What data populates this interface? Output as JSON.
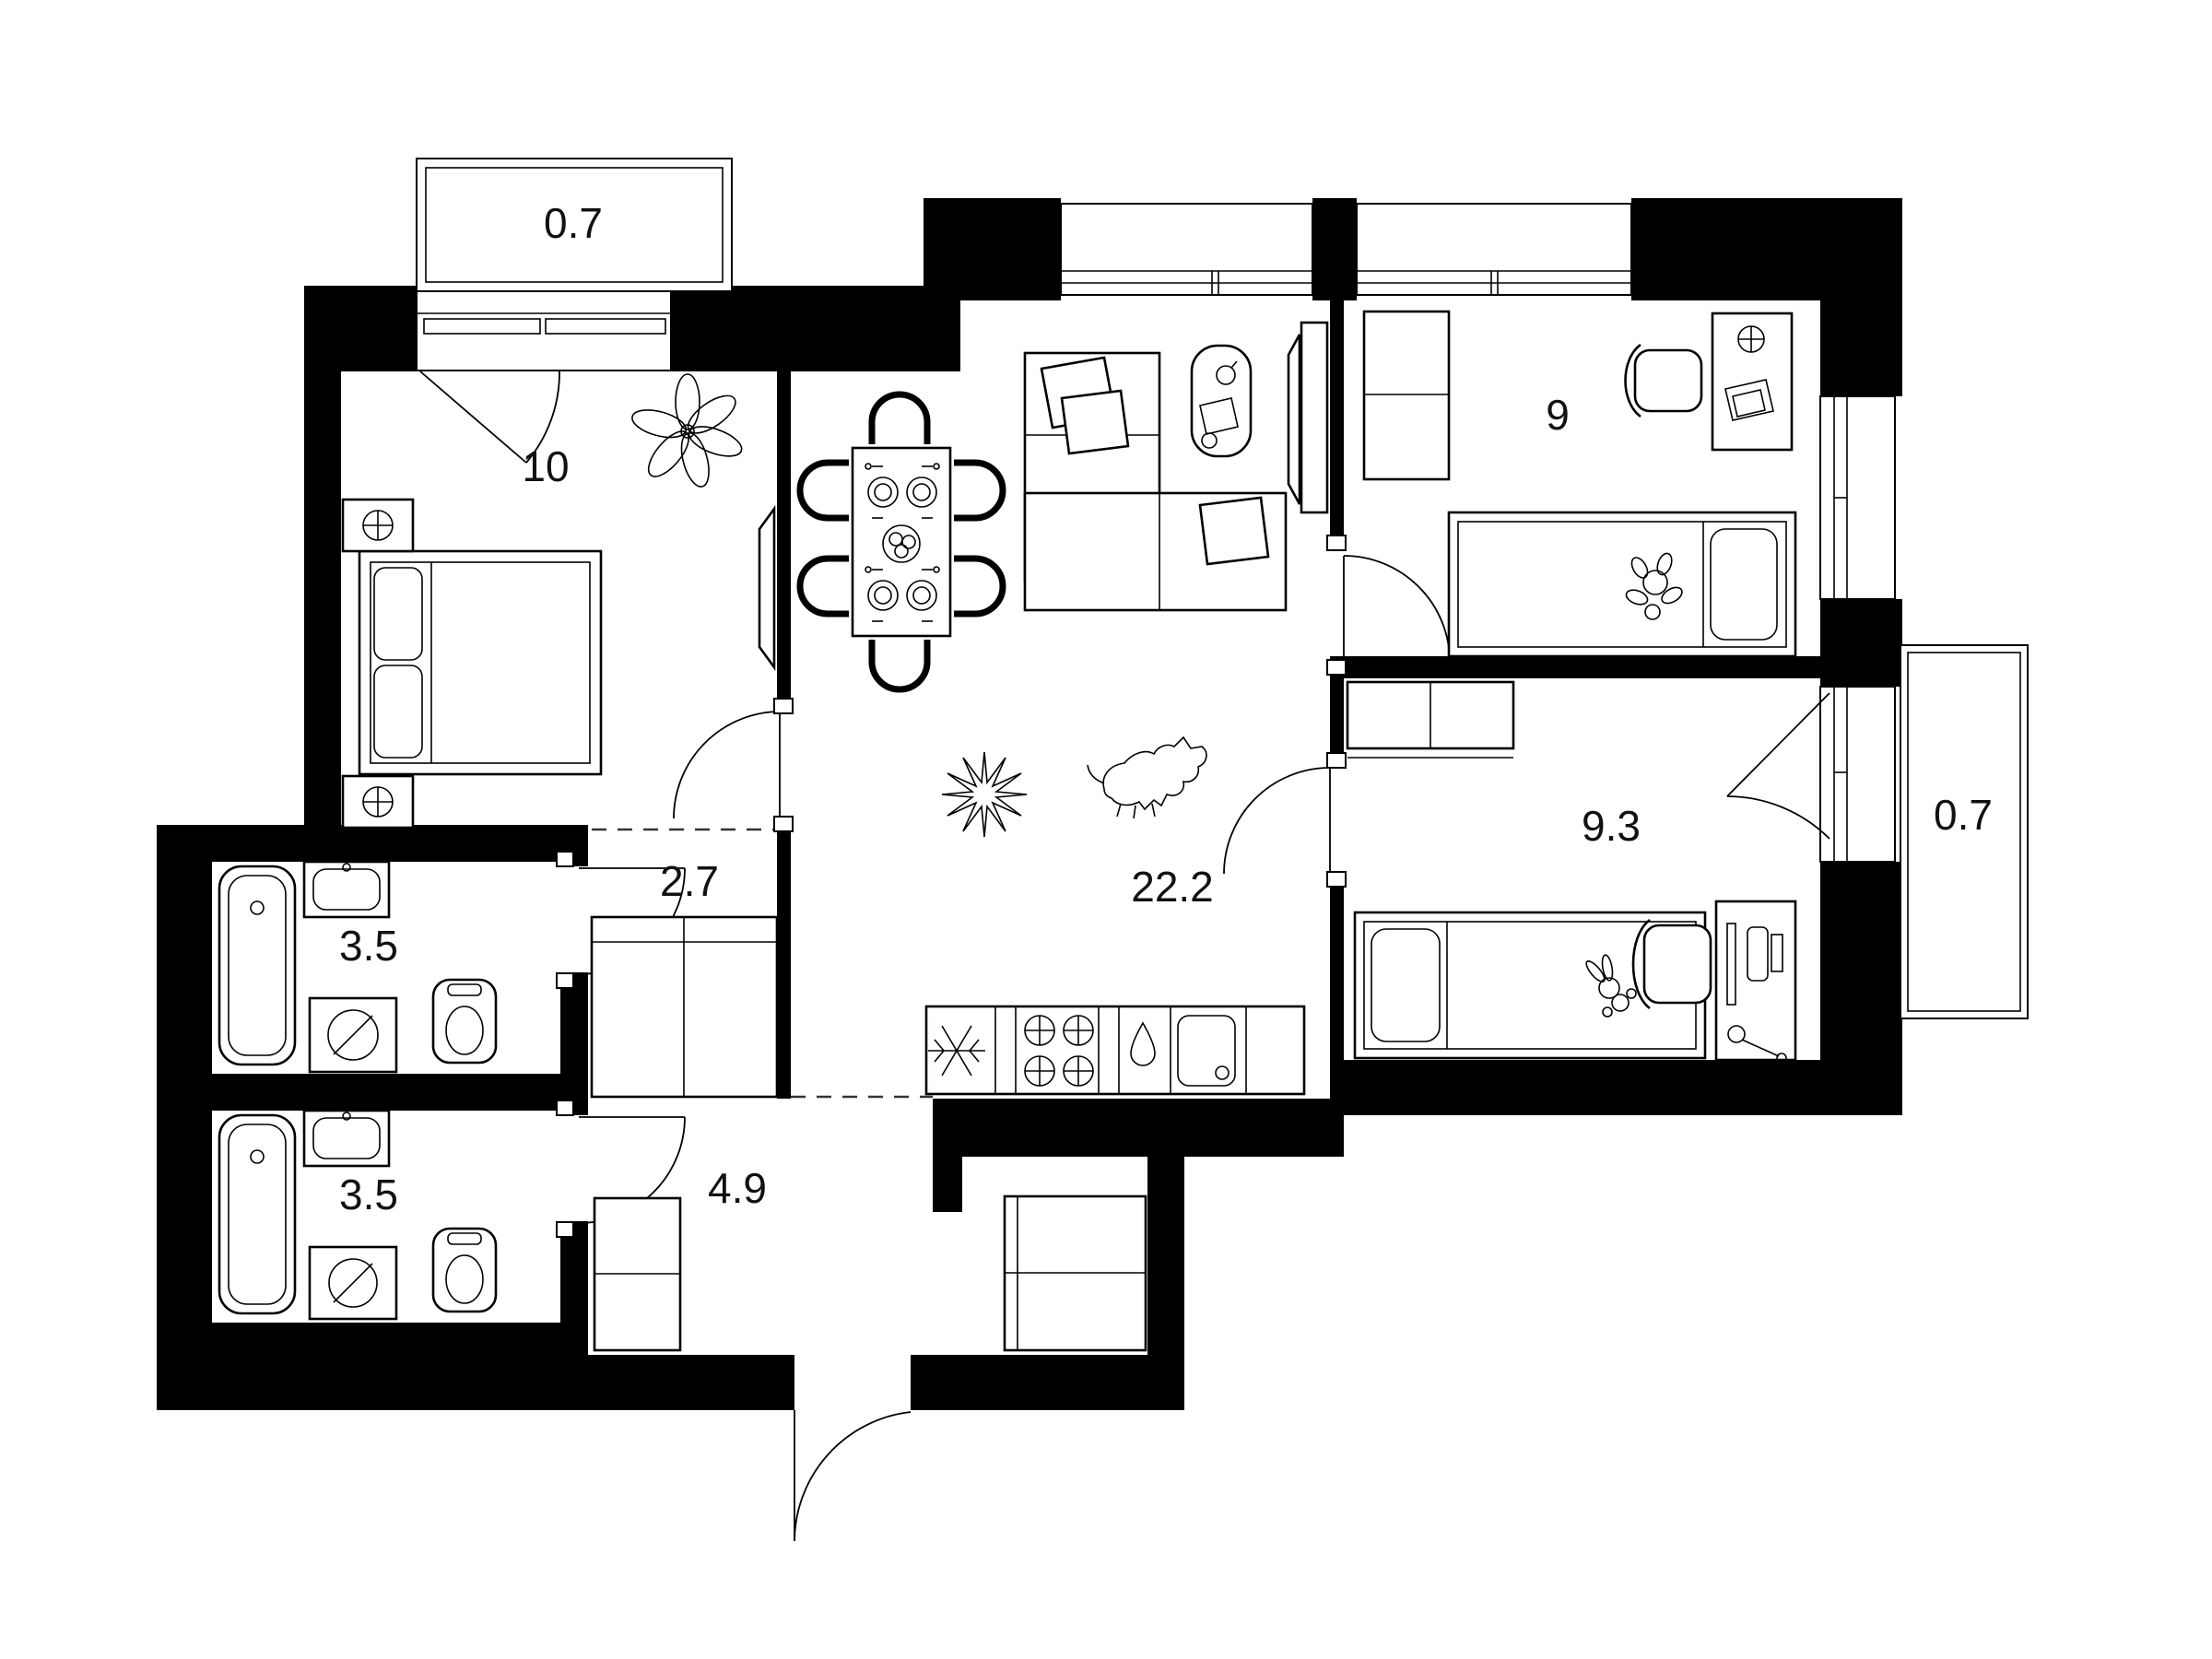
{
  "plan": {
    "type": "apartment-floor-plan",
    "units": "m2",
    "rooms": [
      {
        "name": "balcony-top-left",
        "area_label": "0.7"
      },
      {
        "name": "bedroom",
        "area_label": "10"
      },
      {
        "name": "living-room-kitchen",
        "area_label": "22.2"
      },
      {
        "name": "children-room-1",
        "area_label": "9"
      },
      {
        "name": "children-room-2",
        "area_label": "9.3"
      },
      {
        "name": "balcony-right",
        "area_label": "0.7"
      },
      {
        "name": "bathroom-top",
        "area_label": "3.5"
      },
      {
        "name": "corridor",
        "area_label": "2.7"
      },
      {
        "name": "bathroom-bottom",
        "area_label": "3.5"
      },
      {
        "name": "hallway-entry",
        "area_label": "4.9"
      }
    ],
    "icons": {
      "fridge-icon": "snowflake",
      "stove-icon": "four-crossed-burners",
      "kitchen-sink-icon": "basin-with-drain",
      "dishwasher-icon": "water-drop",
      "bathtub-icon": "tub-with-drain",
      "washing-machine-icon": "drum-with-slash",
      "toilet-icon": "wc-bowl",
      "wall-lamp-icon": "crossed-circle",
      "plant-icon": "leaf-flower",
      "plant-star-icon": "starburst",
      "dog-icon": "lying-dog",
      "door-icon": "quarter-arc-swing",
      "window-icon": "double-line-glazing"
    },
    "colors": {
      "wall": "#000000",
      "line": "#1a1a1a",
      "background": "#ffffff"
    }
  }
}
